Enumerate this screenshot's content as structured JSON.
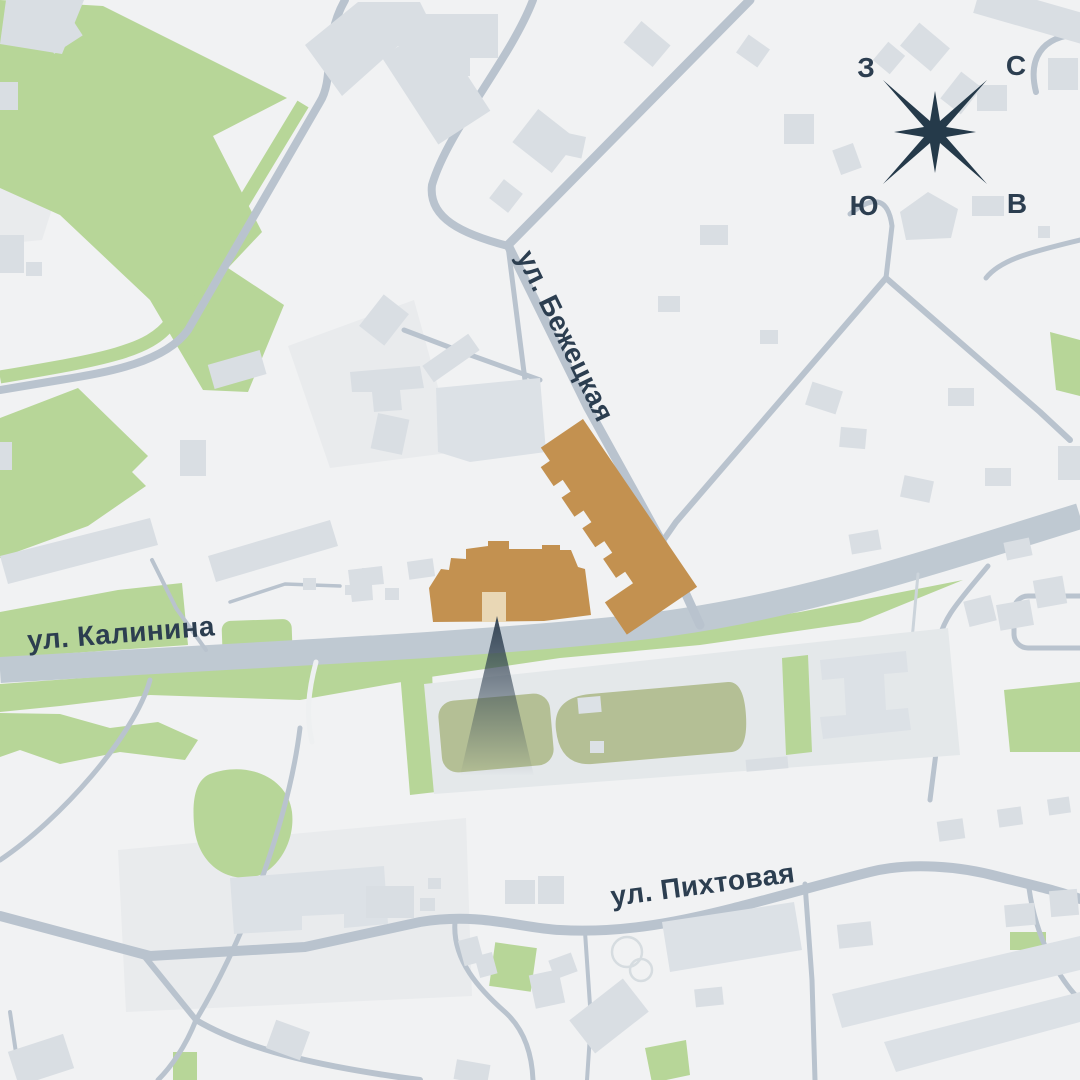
{
  "map": {
    "streets": {
      "bezhetskaya": "ул. Бежецкая",
      "kalinina": "ул. Калинина",
      "pikhtovaya": "ул. Пихтовая"
    },
    "compass": {
      "west": "З",
      "north": "С",
      "south": "Ю",
      "east": "В"
    },
    "colors": {
      "background": "#f1f2f3",
      "building": "#d9dee3",
      "building_pale": "#e9ebed",
      "road": "#b9c3ce",
      "road_major": "#bfc9d2",
      "green": "#b7d698",
      "sports_field": "#b4bf95",
      "highlight_building": "#c39150",
      "highlight_entrance": "#e9d7b5",
      "marker": "#2c3d4e",
      "text": "#2c3e50"
    }
  }
}
